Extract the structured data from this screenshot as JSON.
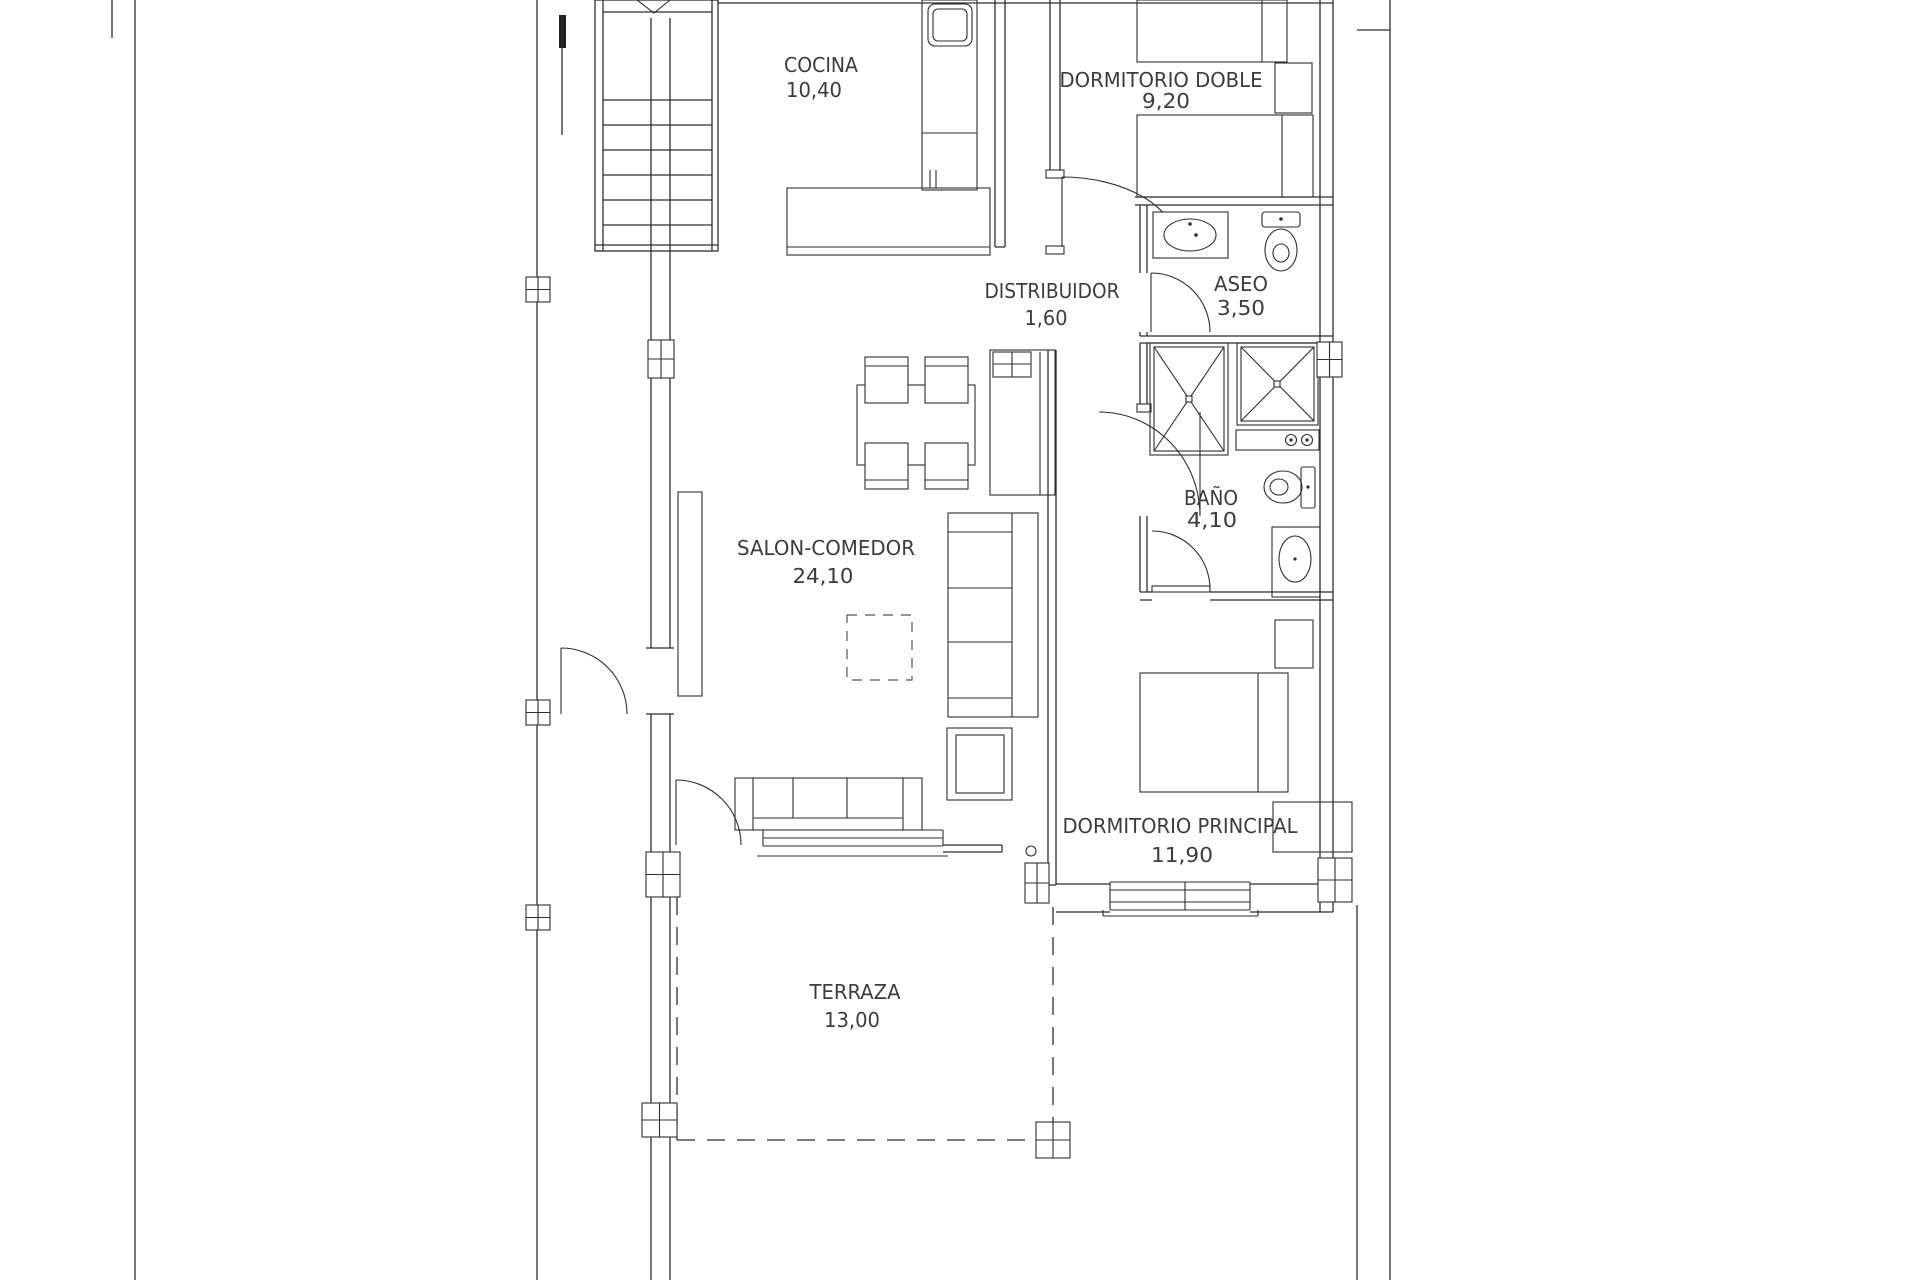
{
  "document": {
    "kind": "architectural floor plan",
    "language": "es"
  },
  "colors": {
    "background": "#ffffff",
    "line": "#2e2e2e",
    "text": "#3c3c3c"
  },
  "rooms": [
    {
      "name": "COCINA",
      "area": "10,40"
    },
    {
      "name": "DORMITORIO  DOBLE",
      "area": "9,20"
    },
    {
      "name": "DISTRIBUIDOR",
      "area": "1,60"
    },
    {
      "name": "ASEO",
      "area": "3,50"
    },
    {
      "name": "BAÑO",
      "area": "4,10"
    },
    {
      "name": "SALON-COMEDOR",
      "area": "24,10"
    },
    {
      "name": "DORMITORIO  PRINCIPAL",
      "area": "11,90"
    },
    {
      "name": "TERRAZA",
      "area": "13,00"
    }
  ]
}
